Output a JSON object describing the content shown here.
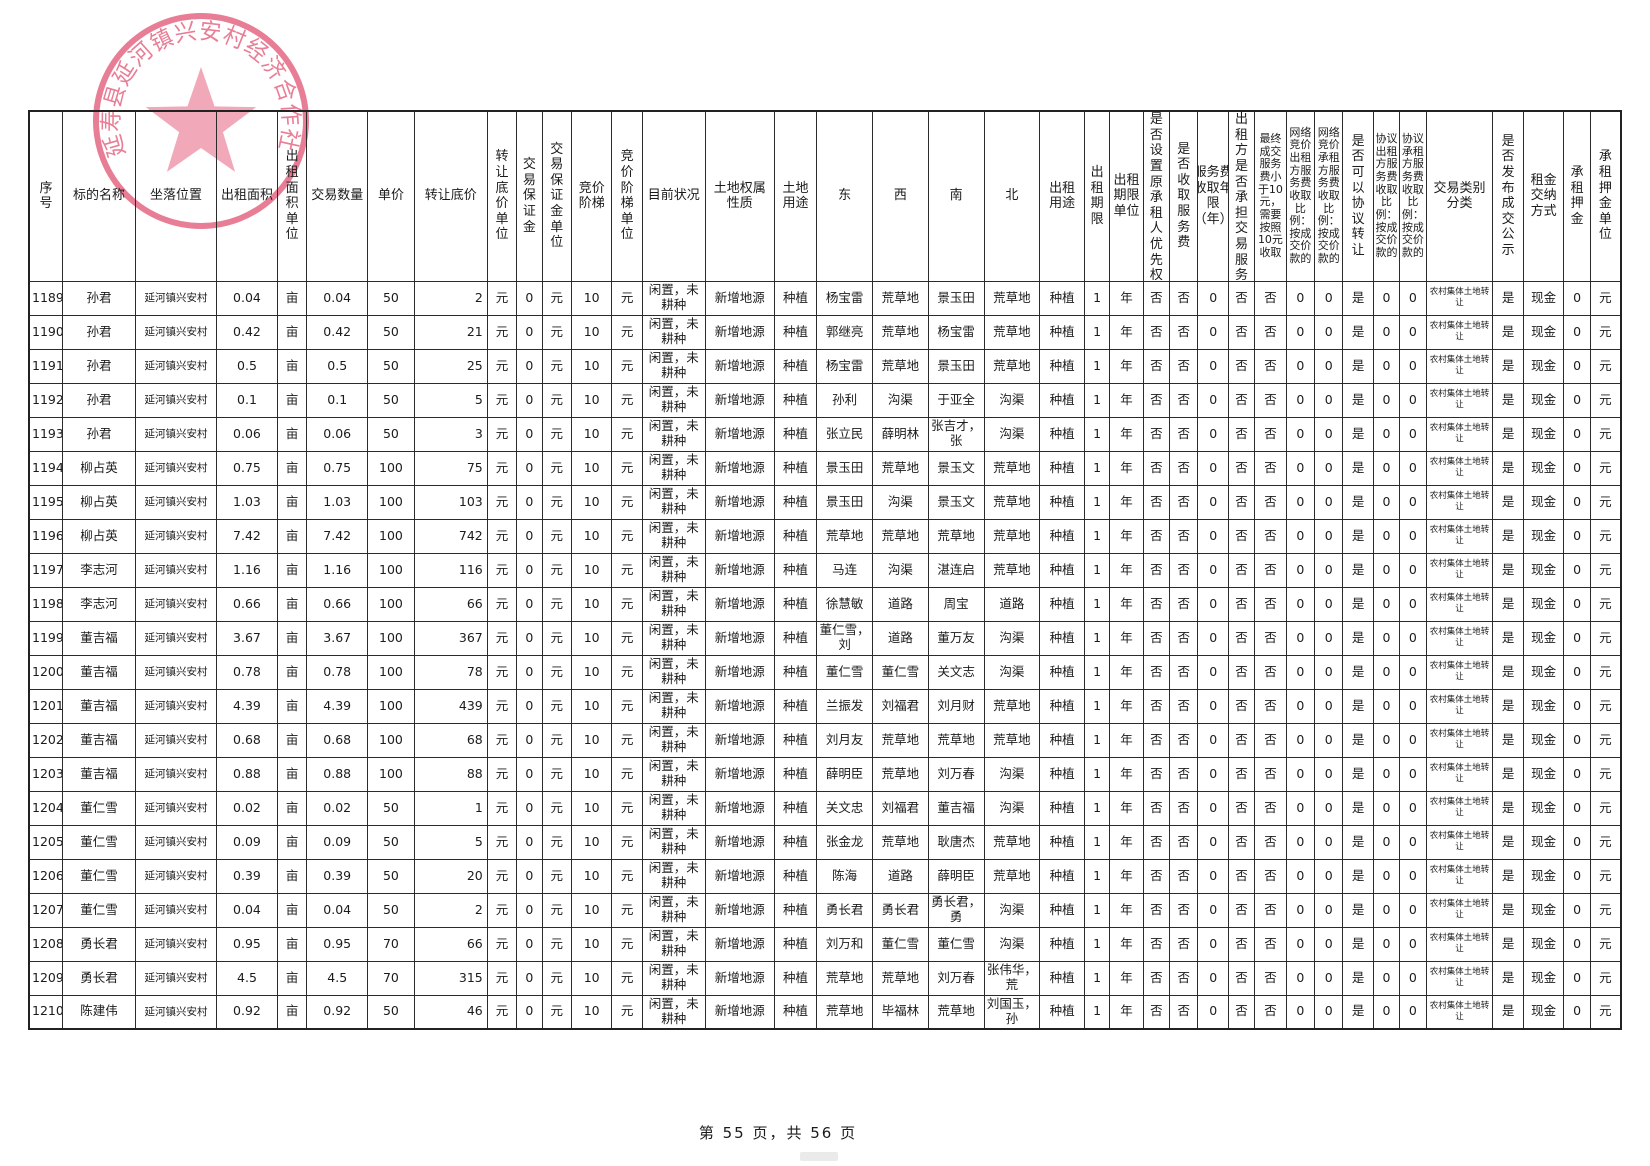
{
  "stamp": {
    "text": "延寿县延河镇兴安村经济合作社"
  },
  "footer": {
    "page_indicator": "第 55 页，共 56 页"
  },
  "table": {
    "headers": [
      "序号",
      "标的名称",
      "坐落位置",
      "出租面积",
      "出租面积单位",
      "交易数量",
      "单价",
      "转让底价",
      "转让底价单位",
      "交易保证金",
      "交易保证金单位",
      "竞价阶梯",
      "竞价阶梯单位",
      "目前状况",
      "土地权属性质",
      "土地用途",
      "东",
      "西",
      "南",
      "北",
      "出租用途",
      "出租期限",
      "出租期限单位",
      "是否设置原承租人优先权",
      "是否收取服务费",
      "服务费收取年限（年）",
      "出租方是否承担交易服务费",
      "最终成交服务费小于10元，需要按照10元收取",
      "网络竞价出租方服务费收取比例：按成交价款的",
      "网络竞价承租方服务费收取比例：按成交价款的",
      "是否可以协议转让",
      "协议出租方服务费收取比例：按成交价款的",
      "协议承租方服务费收取比例：按成交价款的",
      "交易类别分类",
      "是否发布成交公示",
      "租金交纳方式",
      "承租押金",
      "承租押金单位"
    ],
    "row_common": {
      "location": "延河镇兴安村",
      "area_unit": "亩",
      "floor_price_unit": "元",
      "deposit": "0",
      "deposit_unit": "元",
      "bid_step": "10",
      "bid_step_unit": "元",
      "current_status": "闲置，未耕种",
      "ownership": "新增地源",
      "land_use": "种植",
      "lease_use": "种植",
      "lease_term": "1",
      "lease_term_unit": "年",
      "priority": "否",
      "service_fee": "否",
      "service_fee_years": "0",
      "lessor_bears_fee": "否",
      "min_fee_rule": "否",
      "online_lessor_pct": "0",
      "online_lessee_pct": "0",
      "negotiable": "是",
      "nego_lessor_pct": "0",
      "nego_lessee_pct": "0",
      "category": "农村集体土地转让",
      "publicity": "是",
      "payment_method": "现金",
      "deposit_amt": "0",
      "deposit_amt_unit": "元"
    },
    "rows": [
      {
        "seq": "1189",
        "name": "孙君",
        "area": "0.04",
        "quantity": "0.04",
        "unit_price": "50",
        "floor_price": "2",
        "east": "杨宝雷",
        "west": "荒草地",
        "south": "景玉田",
        "north": "荒草地"
      },
      {
        "seq": "1190",
        "name": "孙君",
        "area": "0.42",
        "quantity": "0.42",
        "unit_price": "50",
        "floor_price": "21",
        "east": "郭继亮",
        "west": "荒草地",
        "south": "杨宝雷",
        "north": "荒草地"
      },
      {
        "seq": "1191",
        "name": "孙君",
        "area": "0.5",
        "quantity": "0.5",
        "unit_price": "50",
        "floor_price": "25",
        "east": "杨宝雷",
        "west": "荒草地",
        "south": "景玉田",
        "north": "荒草地"
      },
      {
        "seq": "1192",
        "name": "孙君",
        "area": "0.1",
        "quantity": "0.1",
        "unit_price": "50",
        "floor_price": "5",
        "east": "孙利",
        "west": "沟渠",
        "south": "于亚全",
        "north": "沟渠"
      },
      {
        "seq": "1193",
        "name": "孙君",
        "area": "0.06",
        "quantity": "0.06",
        "unit_price": "50",
        "floor_price": "3",
        "east": "张立民",
        "west": "薛明林",
        "south": "张吉才，张",
        "north": "沟渠"
      },
      {
        "seq": "1194",
        "name": "柳占英",
        "area": "0.75",
        "quantity": "0.75",
        "unit_price": "100",
        "floor_price": "75",
        "east": "景玉田",
        "west": "荒草地",
        "south": "景玉文",
        "north": "荒草地"
      },
      {
        "seq": "1195",
        "name": "柳占英",
        "area": "1.03",
        "quantity": "1.03",
        "unit_price": "100",
        "floor_price": "103",
        "east": "景玉田",
        "west": "沟渠",
        "south": "景玉文",
        "north": "荒草地"
      },
      {
        "seq": "1196",
        "name": "柳占英",
        "area": "7.42",
        "quantity": "7.42",
        "unit_price": "100",
        "floor_price": "742",
        "east": "荒草地",
        "west": "荒草地",
        "south": "荒草地",
        "north": "荒草地"
      },
      {
        "seq": "1197",
        "name": "李志河",
        "area": "1.16",
        "quantity": "1.16",
        "unit_price": "100",
        "floor_price": "116",
        "east": "马连",
        "west": "沟渠",
        "south": "湛连启",
        "north": "荒草地"
      },
      {
        "seq": "1198",
        "name": "李志河",
        "area": "0.66",
        "quantity": "0.66",
        "unit_price": "100",
        "floor_price": "66",
        "east": "徐慧敏",
        "west": "道路",
        "south": "周宝",
        "north": "道路"
      },
      {
        "seq": "1199",
        "name": "董吉福",
        "area": "3.67",
        "quantity": "3.67",
        "unit_price": "100",
        "floor_price": "367",
        "east": "董仁雪，刘",
        "west": "道路",
        "south": "董万友",
        "north": "沟渠"
      },
      {
        "seq": "1200",
        "name": "董吉福",
        "area": "0.78",
        "quantity": "0.78",
        "unit_price": "100",
        "floor_price": "78",
        "east": "董仁雪",
        "west": "董仁雪",
        "south": "关文志",
        "north": "沟渠"
      },
      {
        "seq": "1201",
        "name": "董吉福",
        "area": "4.39",
        "quantity": "4.39",
        "unit_price": "100",
        "floor_price": "439",
        "east": "兰振发",
        "west": "刘福君",
        "south": "刘月财",
        "north": "荒草地"
      },
      {
        "seq": "1202",
        "name": "董吉福",
        "area": "0.68",
        "quantity": "0.68",
        "unit_price": "100",
        "floor_price": "68",
        "east": "刘月友",
        "west": "荒草地",
        "south": "荒草地",
        "north": "荒草地"
      },
      {
        "seq": "1203",
        "name": "董吉福",
        "area": "0.88",
        "quantity": "0.88",
        "unit_price": "100",
        "floor_price": "88",
        "east": "薛明臣",
        "west": "荒草地",
        "south": "刘万春",
        "north": "沟渠"
      },
      {
        "seq": "1204",
        "name": "董仁雪",
        "area": "0.02",
        "quantity": "0.02",
        "unit_price": "50",
        "floor_price": "1",
        "east": "关文忠",
        "west": "刘福君",
        "south": "董吉福",
        "north": "沟渠"
      },
      {
        "seq": "1205",
        "name": "董仁雪",
        "area": "0.09",
        "quantity": "0.09",
        "unit_price": "50",
        "floor_price": "5",
        "east": "张金龙",
        "west": "荒草地",
        "south": "耿唐杰",
        "north": "荒草地"
      },
      {
        "seq": "1206",
        "name": "董仁雪",
        "area": "0.39",
        "quantity": "0.39",
        "unit_price": "50",
        "floor_price": "20",
        "east": "陈海",
        "west": "道路",
        "south": "薛明臣",
        "north": "荒草地"
      },
      {
        "seq": "1207",
        "name": "董仁雪",
        "area": "0.04",
        "quantity": "0.04",
        "unit_price": "50",
        "floor_price": "2",
        "east": "勇长君",
        "west": "勇长君",
        "south": "勇长君，勇",
        "north": "沟渠"
      },
      {
        "seq": "1208",
        "name": "勇长君",
        "area": "0.95",
        "quantity": "0.95",
        "unit_price": "70",
        "floor_price": "66",
        "east": "刘万和",
        "west": "董仁雪",
        "south": "董仁雪",
        "north": "沟渠"
      },
      {
        "seq": "1209",
        "name": "勇长君",
        "area": "4.5",
        "quantity": "4.5",
        "unit_price": "70",
        "floor_price": "315",
        "east": "荒草地",
        "west": "荒草地",
        "south": "刘万春",
        "north": "张伟华，荒"
      },
      {
        "seq": "1210",
        "name": "陈建伟",
        "area": "0.92",
        "quantity": "0.92",
        "unit_price": "50",
        "floor_price": "46",
        "east": "荒草地",
        "west": "毕福林",
        "south": "荒草地",
        "north": "刘国玉，孙"
      }
    ]
  }
}
